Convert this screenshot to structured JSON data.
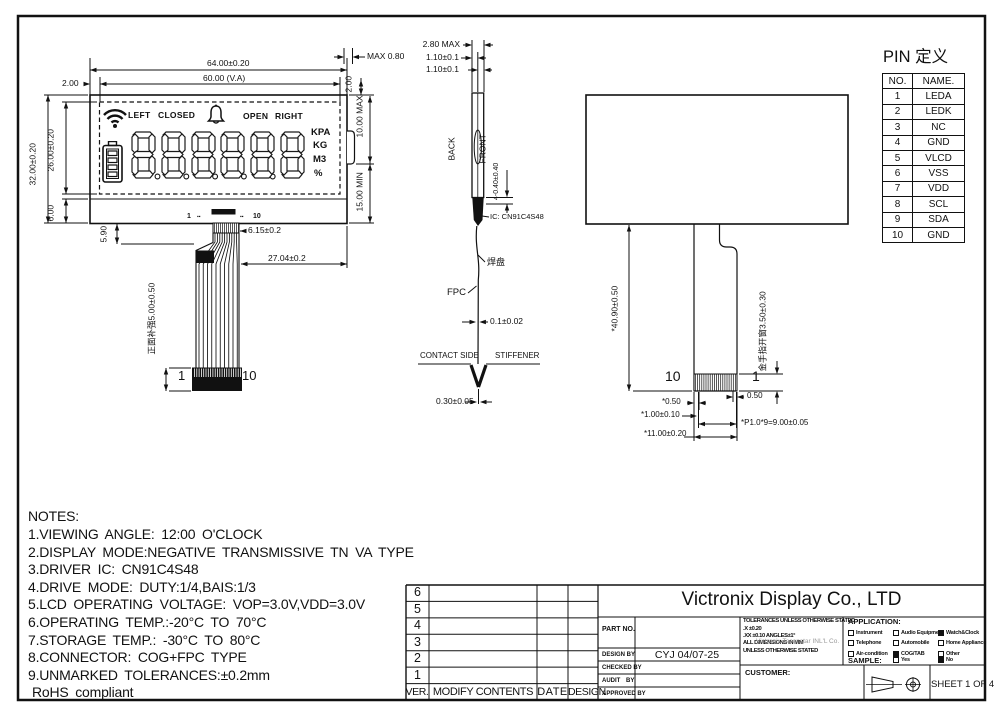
{
  "front_view": {
    "dims": {
      "w64": "64.00±0.20",
      "w60": "60.00 (V.A)",
      "off2": "2.00",
      "h32": "32.00±0.20",
      "h26": "26.00±0.20",
      "h6": "6.00",
      "max080": "MAX 0.80",
      "off2r": "2.00",
      "max10": "10.00 MAX",
      "min15": "15.00 MIN",
      "d590": "5.90",
      "d615": "6.15±0.2",
      "d2704": "27.04±0.2",
      "stiff": "正面补强5.00±0.50",
      "pin1s": "1",
      "pin10s": "10",
      "dots": "▪▪",
      "tail1": "1",
      "tail10": "10"
    },
    "lcd": {
      "labels": [
        "LEFT",
        "CLOSED",
        "OPEN",
        "RIGHT"
      ],
      "units": [
        "KPA",
        "KG",
        "M3",
        "%"
      ],
      "digits": "888888",
      "icons": [
        "wifi-icon",
        "bell-icon",
        "battery-icon"
      ]
    }
  },
  "side_view": {
    "d280": "2.80 MAX",
    "t1": "1.10±0.1",
    "t2": "1.10±0.1",
    "back": "BACK",
    "front": "FRONT",
    "d040": "4-0.40±0.40",
    "ic": "IC: CN91C4S48",
    "pad": "焊盘",
    "fpc": "FPC",
    "t01": "0.1±0.02",
    "contact": "CONTACT SIDE",
    "stiffener": "STIFFENER",
    "d030": "0.30±0.05"
  },
  "back_view": {
    "len4090": "*40.90±0.50",
    "window": "金手指开窗3.50±0.30",
    "pin10": "10",
    "pin1": "1",
    "d050a": "*0.50",
    "d050b": "0.50",
    "d100": "*1.00±0.10",
    "pitch": "*P1.0*9=9.00±0.05",
    "d1100": "*11.00±0.20"
  },
  "pin_table": {
    "title": "PIN 定义",
    "headers": [
      "NO.",
      "NAME."
    ],
    "rows": [
      [
        "1",
        "LEDA"
      ],
      [
        "2",
        "LEDK"
      ],
      [
        "3",
        "NC"
      ],
      [
        "4",
        "GND"
      ],
      [
        "5",
        "VLCD"
      ],
      [
        "6",
        "VSS"
      ],
      [
        "7",
        "VDD"
      ],
      [
        "8",
        "SCL"
      ],
      [
        "9",
        "SDA"
      ],
      [
        "10",
        "GND"
      ]
    ]
  },
  "notes": {
    "title": "NOTES:",
    "lines": [
      "1.VIEWING ANGLE: 12:00 O'CLOCK",
      "2.DISPLAY MODE:NEGATIVE TRANSMISSIVE TN VA TYPE",
      "3.DRIVER IC: CN91C4S48",
      "4.DRIVE MODE: DUTY:1/4,BAIS:1/3",
      "5.LCD OPERATING VOLTAGE: VOP=3.0V,VDD=3.0V",
      "6.OPERATING TEMP.:-20°C TO 70°C",
      "7.STORAGE TEMP.: -30°C TO 80°C",
      "8.CONNECTOR: COG+FPC TYPE",
      "9.UNMARKED TOLERANCES:±0.2mm",
      "RoHS compliant"
    ]
  },
  "title_block": {
    "company": "Victronix Display Co., LTD",
    "rev_rows": [
      "6",
      "5",
      "4",
      "3",
      "2",
      "1"
    ],
    "rev_headers": [
      "VER.",
      "MODIFY CONTENTS",
      "DATE",
      "DESIGN"
    ],
    "part_no_label": "PART NO.",
    "design_by_label": "DESIGN BY",
    "design_by_value": "CYJ 04/07-25",
    "checked_by_label": "CHECKED BY",
    "audit_by_label": "AUDIT BY",
    "approved_by_label": "APPROVED BY",
    "tolerances": [
      "TOLERANCES UNLESS OTHERWISE STATED",
      ".X ±0.20",
      ".XX ±0.10   ANGLES±1°",
      "ALL DIMENSIONS IN MM",
      "UNLESS OTHERWISE STATED"
    ],
    "watermark": "Victronix Tecenstar INL'L Co.",
    "application": {
      "label": "APPLICATION:",
      "items": [
        {
          "label": "Instrument",
          "checked": false
        },
        {
          "label": "Audio Equipment",
          "checked": false
        },
        {
          "label": "Watch&Clock",
          "checked": true
        },
        {
          "label": "Telephone",
          "checked": false
        },
        {
          "label": "Automobile",
          "checked": false
        },
        {
          "label": "Home Appliance",
          "checked": false
        },
        {
          "label": "Air-condition",
          "checked": false
        },
        {
          "label": "COG/TAB",
          "checked": true
        },
        {
          "label": "Other",
          "checked": false
        }
      ],
      "sample_label": "SAMPLE:",
      "sample_options": [
        {
          "label": "Yes",
          "checked": false
        },
        {
          "label": "No",
          "checked": true
        }
      ]
    },
    "customer_label": "CUSTOMER:",
    "sheet": "SHEET 1 OF 4"
  }
}
